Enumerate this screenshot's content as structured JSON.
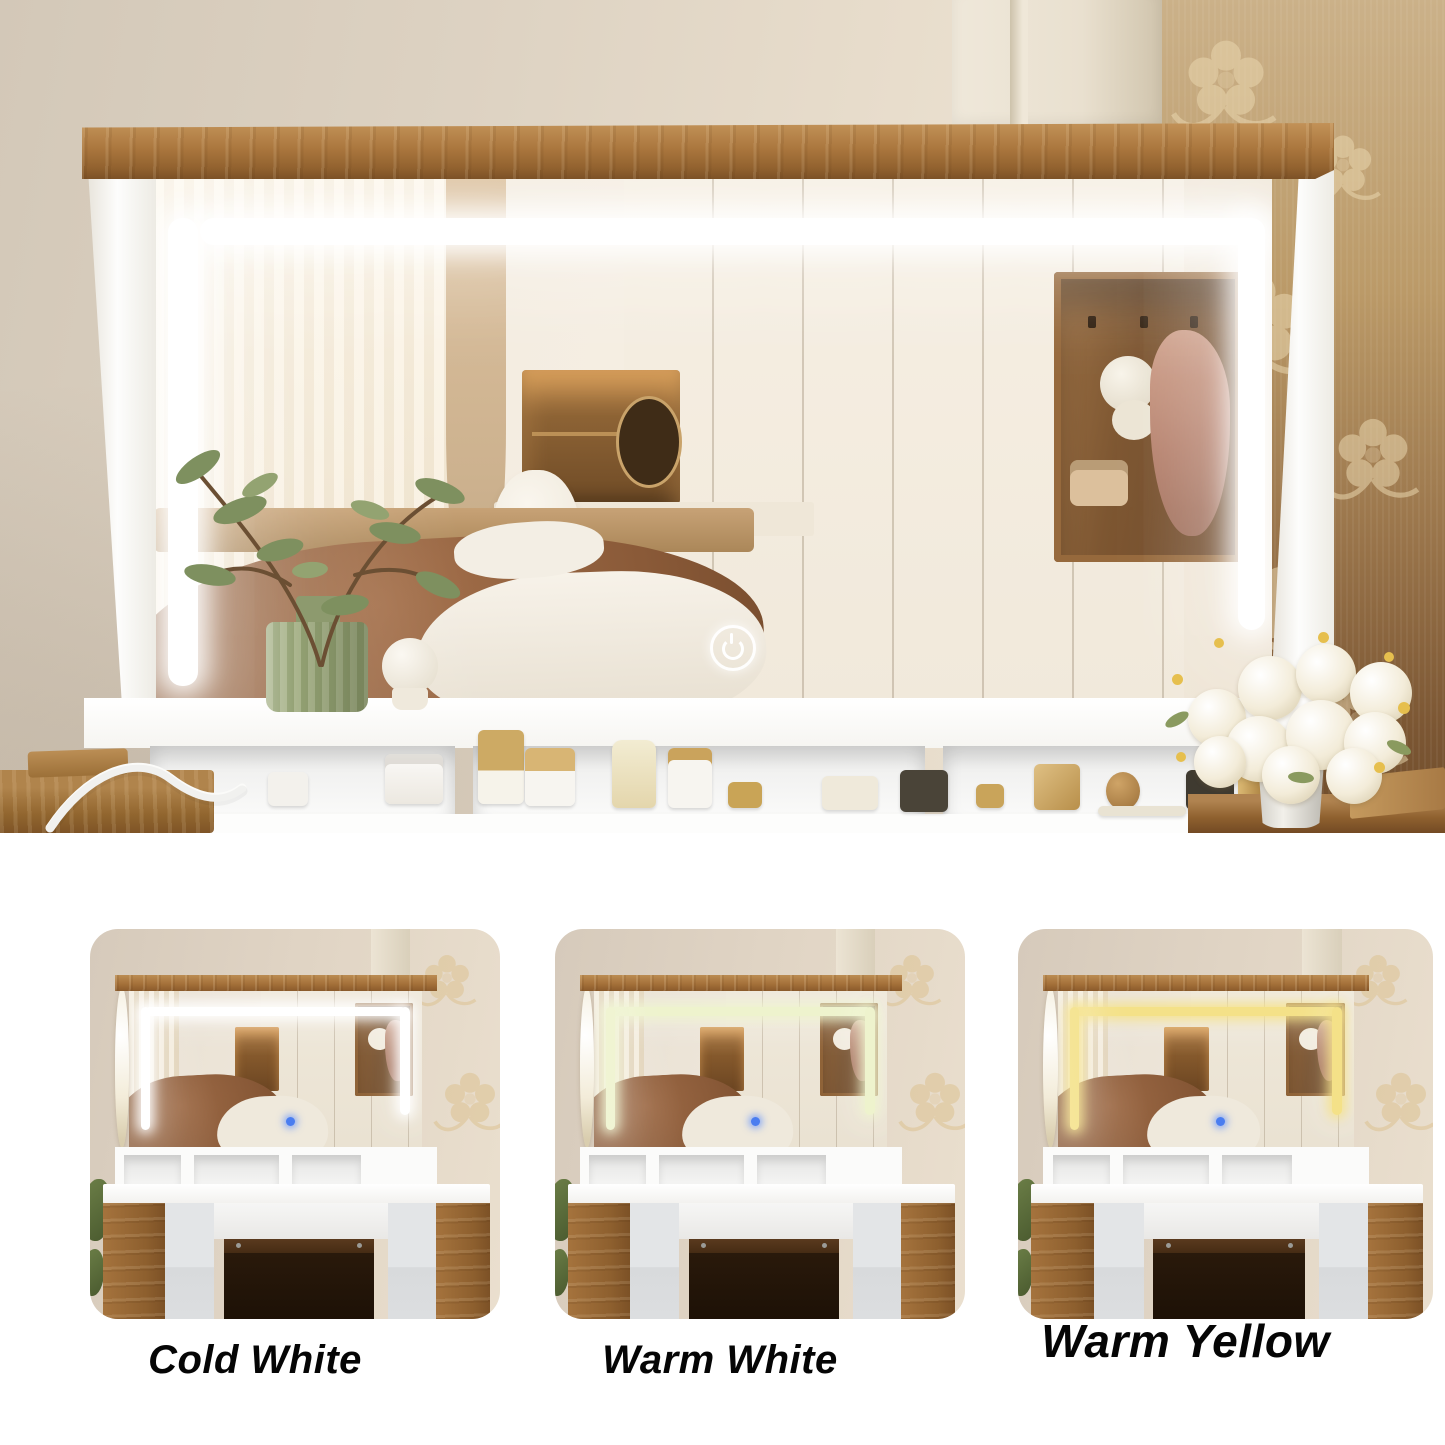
{
  "page": {
    "background": "#ffffff"
  },
  "hero": {
    "led": {
      "color": "#ffffff",
      "glow": "rgba(255,255,255,0.92)"
    },
    "touch_button": {
      "icon": "power-icon"
    },
    "palette": {
      "wall": "#ddd2c2",
      "wood_shelf": "#a9743c",
      "wallpaper_top": "#cbb189",
      "wallpaper_bottom": "#6f4c2b",
      "frame": "#fdfdfc",
      "console": "#fbfbfa",
      "flowers": "#f3ecd9",
      "vase_green": "#9aa77b"
    }
  },
  "variants": [
    {
      "id": "cold-white",
      "label": "Cold White",
      "led_color": "#ffffff",
      "led_glow": "rgba(255,255,255,0.95)",
      "touch_dot": "#4a7df0"
    },
    {
      "id": "warm-white",
      "label": "Warm White",
      "led_color": "#eef3cd",
      "led_glow": "rgba(238,243,205,0.95)",
      "touch_dot": "#4a7df0"
    },
    {
      "id": "warm-yellow",
      "label": "Warm Yellow",
      "led_color": "#f4e188",
      "led_glow": "rgba(244,225,136,0.95)",
      "touch_dot": "#4a7df0"
    }
  ]
}
